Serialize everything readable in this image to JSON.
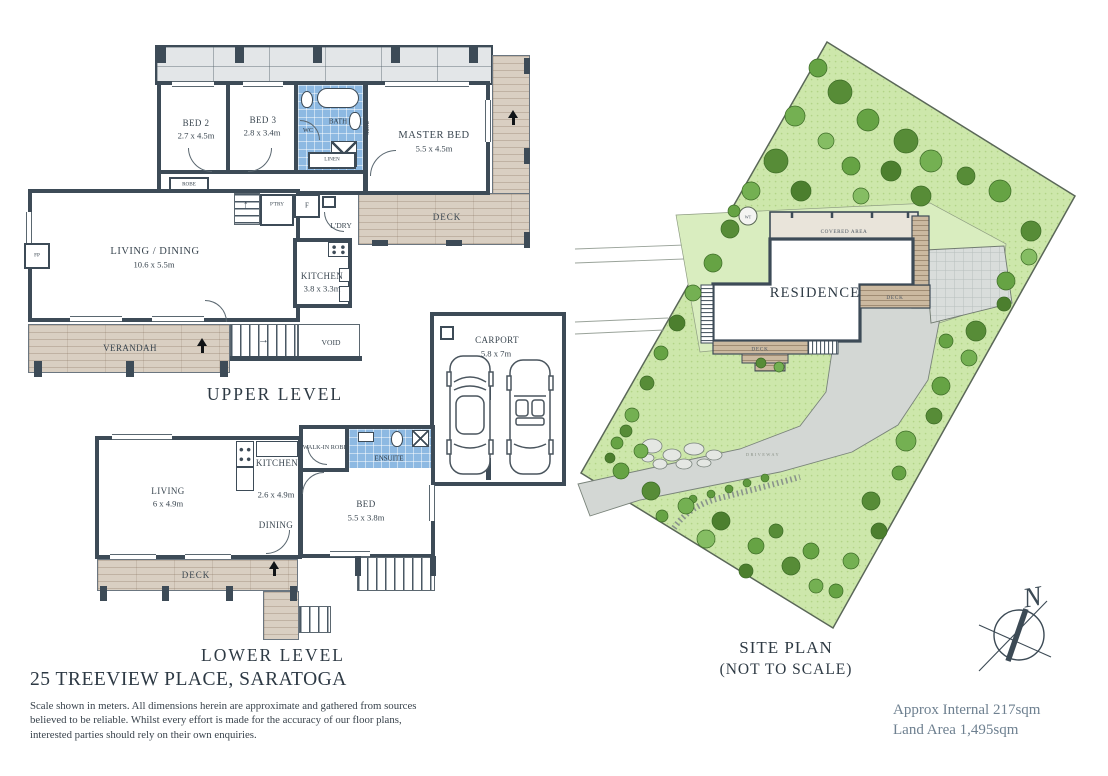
{
  "page": {
    "address": "25 TREEVIEW PLACE, SARATOGA",
    "disclaimer": "Scale shown in meters. All dimensions herein are approximate and gathered from sources believed to be reliable. Whilst every effort is made for the accuracy of our floor plans, interested parties should rely on their own enquiries.",
    "approx_internal": "Approx Internal 217sqm",
    "land_area": "Land Area 1,495sqm"
  },
  "upper": {
    "caption": "UPPER LEVEL",
    "bed2": {
      "name": "BED 2",
      "dims": "2.7 x 4.5m"
    },
    "bed3": {
      "name": "BED 3",
      "dims": "2.8 x 3.4m"
    },
    "wc": "WC",
    "bath": "BATH",
    "robe_master": "ROBE",
    "robe_bed2": "ROBE",
    "linen": "LINEN",
    "master": {
      "name": "MASTER BED",
      "dims": "5.5 x 4.5m"
    },
    "living": {
      "name": "LIVING / DINING",
      "dims": "10.6 x 5.5m"
    },
    "kitchen": {
      "name": "KITCHEN",
      "dims": "3.8 x 3.3m"
    },
    "pantry": "P'TRY",
    "fridge": "F",
    "laundry": "L'DRY",
    "fireplace": "FP",
    "verandah": "VERANDAH",
    "void": "VOID",
    "deck": "DECK"
  },
  "carport": {
    "name": "CARPORT",
    "dims": "5.8 x 7m"
  },
  "lower": {
    "caption": "LOWER LEVEL",
    "living": {
      "name": "LIVING",
      "dims": "6 x 4.9m"
    },
    "kitchen": {
      "name": "KITCHEN",
      "dims": "2.6 x 4.9m"
    },
    "dining": "DINING",
    "walkin_robe": "WALK-IN ROBE",
    "ensuite": "ENSUITE",
    "bed": {
      "name": "BED",
      "dims": "5.5 x 3.8m"
    },
    "deck": "DECK"
  },
  "site": {
    "caption1": "SITE PLAN",
    "caption2": "(NOT TO SCALE)",
    "residence": "RESIDENCE",
    "covered_area": "COVERED AREA",
    "deck_east": "DECK",
    "deck_south": "DECK",
    "driveway": "DRIVEWAY",
    "water_tank": "WT",
    "north": "N"
  },
  "colors": {
    "wall": "#3d4b57",
    "bath_blue": "#8db9e2",
    "deck_wood": "#d9cfc2",
    "site_grass": "#cde7ab",
    "tree_green": "#5f9a3e",
    "paving_grey": "#d3d7d4",
    "muted_text": "#6e8090"
  }
}
